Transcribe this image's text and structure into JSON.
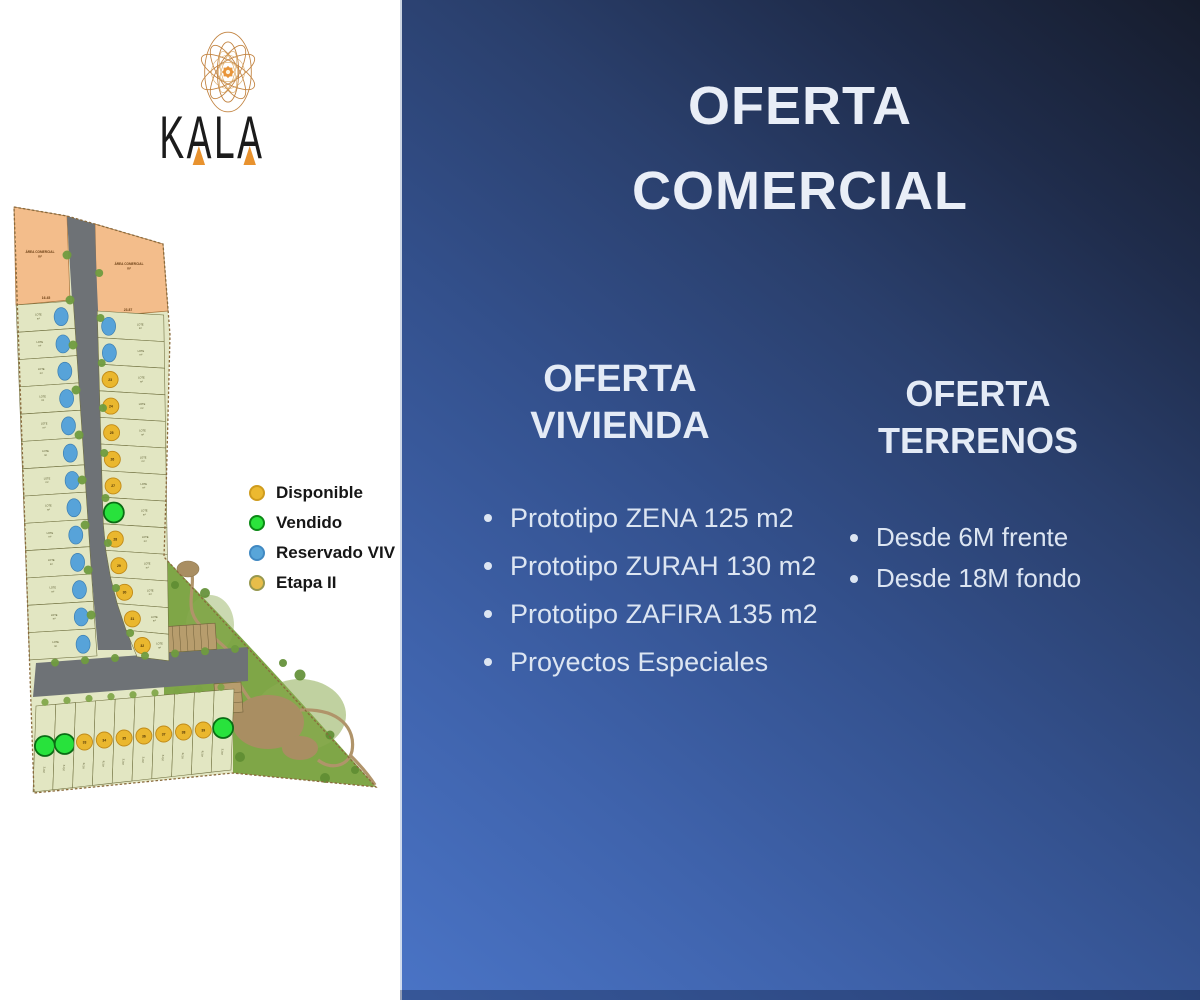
{
  "brand": {
    "name": "KALA"
  },
  "title": {
    "line1": "OFERTA",
    "line2": "COMERCIAL"
  },
  "offers": {
    "vivienda": {
      "heading": [
        "OFERTA",
        "VIVIENDA"
      ],
      "bullets": [
        "Prototipo ZENA 125 m2",
        "Prototipo ZURAH 130 m2",
        "Prototipo ZAFIRA 135 m2",
        "Proyectos Especiales"
      ]
    },
    "terrenos": {
      "heading": [
        "OFERTA",
        "TERRENOS"
      ],
      "bullets": [
        "Desde 6M frente",
        "Desde 18M fondo"
      ]
    }
  },
  "legend": {
    "items": [
      {
        "label": "Disponible",
        "color": "#ecb930",
        "border": "#cf9c1e"
      },
      {
        "label": "Vendido",
        "color": "#2be33c",
        "border": "#0c8a16"
      },
      {
        "label": "Reservado VIV",
        "color": "#58a5d9",
        "border": "#4189c2"
      },
      {
        "label": "Etapa II",
        "color": "#e7bd4a",
        "border": "#97984f"
      }
    ]
  },
  "site_map": {
    "commercial_area_label": "ÁREA COMERCIAL",
    "area_unit": "m²",
    "lot_label": "LOTE",
    "dimension_labels": [
      "16.45",
      "23.87"
    ],
    "status_colors": {
      "disponible": "#eab72e",
      "vendido": "#28e23c",
      "reservado": "#57a3d9"
    },
    "left_column_statuses": [
      "reservado",
      "reservado",
      "reservado",
      "reservado",
      "reservado",
      "reservado",
      "reservado",
      "reservado",
      "reservado",
      "reservado",
      "reservado",
      "reservado",
      "reservado"
    ],
    "right_column_statuses": [
      "reservado",
      "reservado",
      "disponible",
      "disponible",
      "disponible",
      "disponible",
      "disponible",
      "vendido",
      "disponible",
      "disponible",
      "disponible",
      "disponible",
      "disponible"
    ],
    "right_column_numbers": [
      "",
      "",
      "23",
      "24",
      "25",
      "26",
      "27",
      "",
      "28",
      "29",
      "30",
      "31",
      "32"
    ],
    "bottom_row_statuses": [
      "vendido",
      "vendido",
      "disponible",
      "disponible",
      "disponible",
      "disponible",
      "disponible",
      "disponible",
      "disponible",
      "vendido"
    ],
    "bottom_row_numbers": [
      "",
      "",
      "33",
      "34",
      "35",
      "36",
      "37",
      "38",
      "39",
      ""
    ]
  }
}
